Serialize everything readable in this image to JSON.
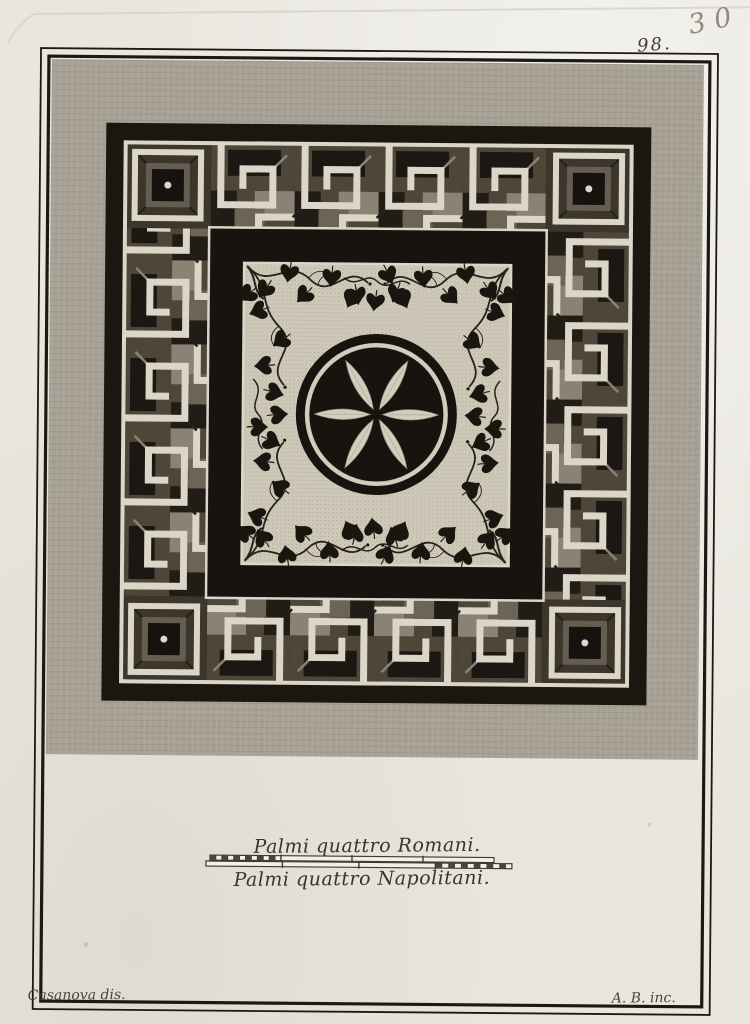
{
  "plate": {
    "pencil_number": "30",
    "plate_number": "98.",
    "caption_scale_roman": "Palmi quattro Romani.",
    "caption_scale_neapolitan": "Palmi quattro Napolitani.",
    "credit_designer": "Casanova dis.",
    "credit_engraver": "A. B. inc."
  },
  "artwork": {
    "medium": "copperplate engraving of a mosaic pavement",
    "border_pattern": "perspective greek-key meander band",
    "corner_motif": "beveled square with central white dot",
    "center_motif": "six-petal rosette inside double-ring medallion",
    "rosette_petal_count": 6,
    "garland": "ivy vine with heart-shaped leaves along the inner panel edges",
    "scale_bars": {
      "bars": 2,
      "top_unit": "palmi romani",
      "bottom_unit": "palmi napolitani",
      "palmi_per_bar": 4,
      "subdivided_palmo_ticks": 12
    },
    "colors": {
      "paper": "#e9e6df",
      "plate_ground": "#a7a196",
      "ink_dark": "#17130e",
      "tessera_light": "#dbd6c7",
      "bevel_mid": "#8a8375",
      "pencil_gray": "#928c7f"
    }
  }
}
